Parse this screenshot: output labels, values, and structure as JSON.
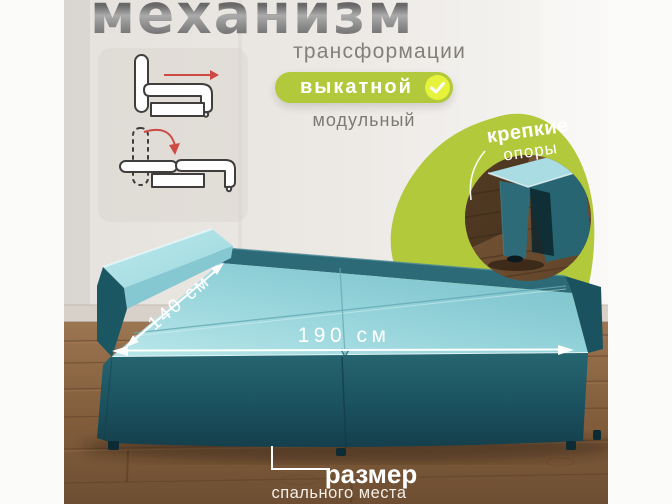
{
  "header": {
    "title": "механизм",
    "subtitle": "трансформации",
    "badge": {
      "label": "выкатной",
      "icon": "checkmark-icon"
    },
    "badge_secondary": "модульный"
  },
  "mechanism_diagrams": {
    "pullout_icon": "sofa-pullout-arrow-icon",
    "fold_icon": "sofa-backrest-fold-icon"
  },
  "feature_badge": {
    "line1": "крепкие",
    "line2": "опоры"
  },
  "dimensions": {
    "depth": "140 см",
    "length": "190 см"
  },
  "caption": {
    "title": "размер",
    "subtitle": "спального места"
  },
  "colors": {
    "accent_green": "#b3c93c",
    "check_yellow": "#e6f23c",
    "sofa_teal": "#1d5864",
    "sofa_aqua": "#9ad8de",
    "floor_brown": "#83613f",
    "wall_gray": "#eae6e2",
    "arrow_red": "#cd4a45",
    "title_gray": "#6f6f6f"
  }
}
